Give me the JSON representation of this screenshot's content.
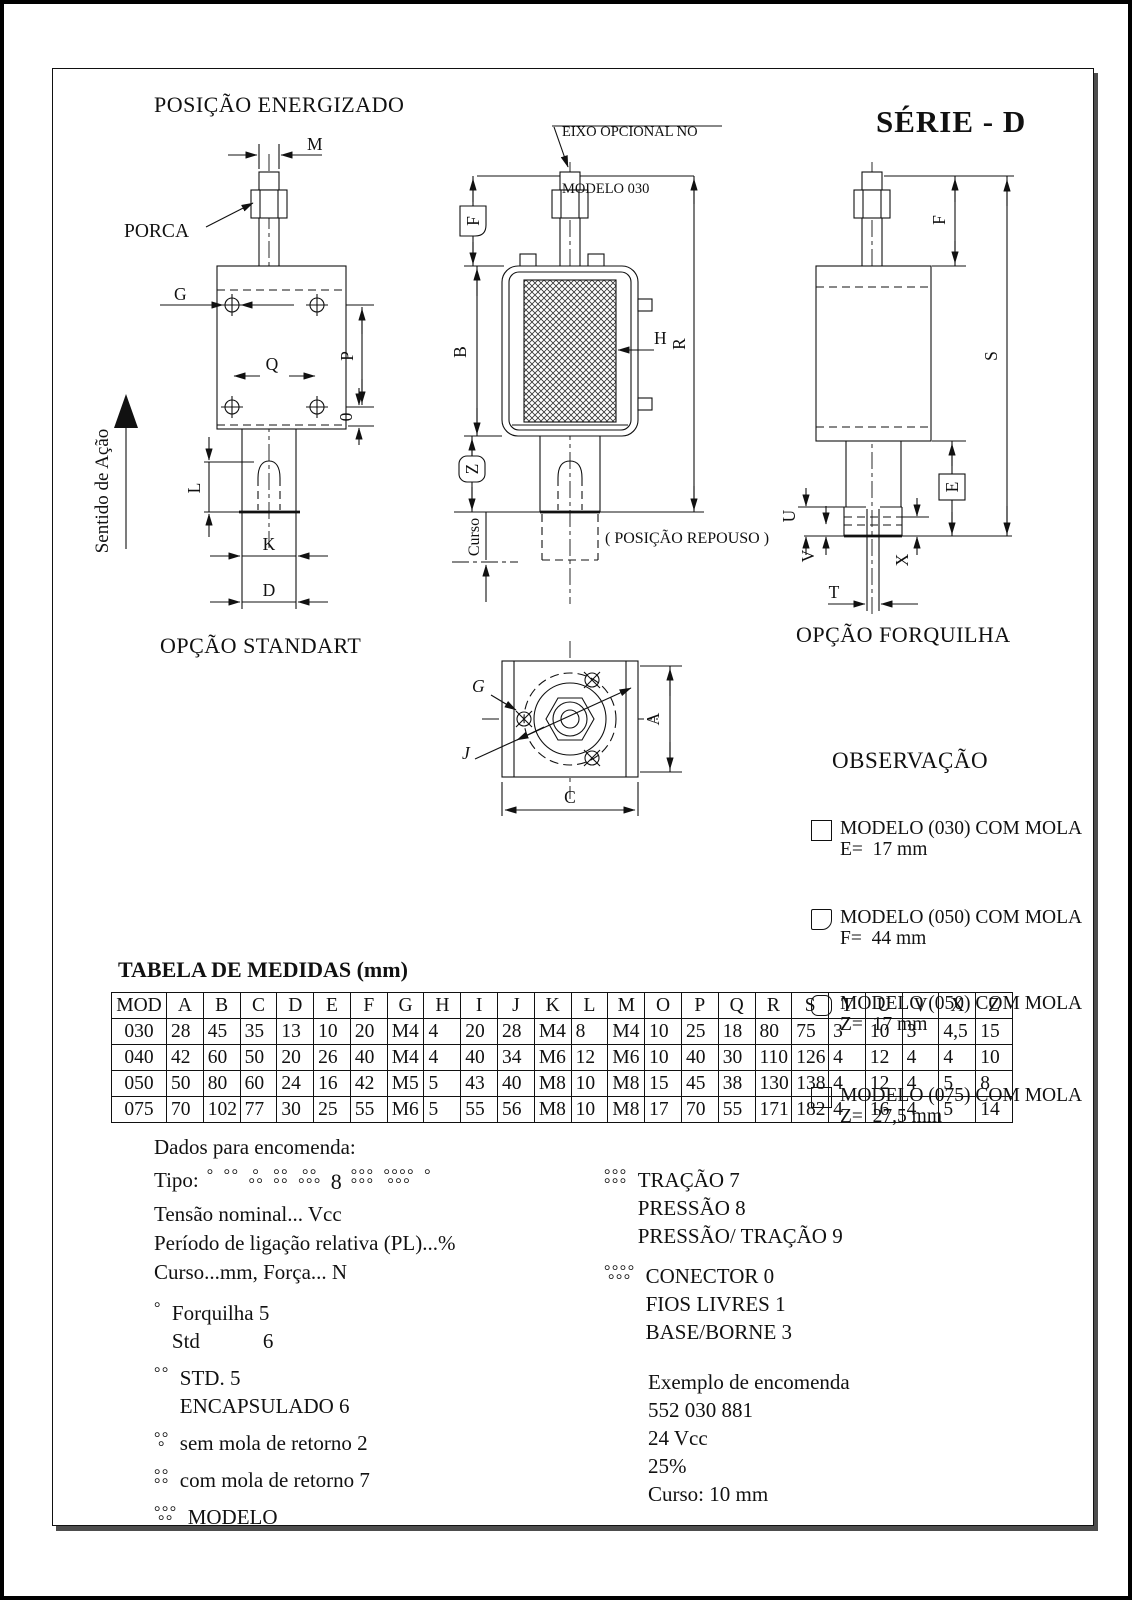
{
  "titles": {
    "posicao_energizado": "POSIÇÃO ENERGIZADO",
    "serie": "SÉRIE - D",
    "eixo_line1": "EIXO OPCIONAL NO",
    "eixo_line2": "MODELO 030",
    "opcao_standart": "OPÇÃO STANDART",
    "opcao_forquilha": "OPÇÃO FORQUILHA",
    "posicao_repouso": "( POSIÇÃO REPOUSO )"
  },
  "labels": {
    "m": "M",
    "porca": "PORCA",
    "g": "G",
    "q": "Q",
    "p": "P",
    "zero": "0",
    "l": "L",
    "k": "K",
    "d": "D",
    "sentido": "Sentido de Ação",
    "f_mid": "F",
    "b": "B",
    "h": "H",
    "r": "R",
    "z": "Z",
    "curso": "Curso",
    "g_bot": "G",
    "j": "J",
    "a": "A",
    "c": "C",
    "f_right": "F",
    "s": "S",
    "e": "E",
    "u": "U",
    "v": "V",
    "t": "T",
    "x": "X"
  },
  "observacao": {
    "title": "OBSERVAÇÃO",
    "items": [
      {
        "icon": "square",
        "line1": "MODELO (030) COM MOLA",
        "line2": "E=  17 mm"
      },
      {
        "icon": "corner",
        "line1": "MODELO (050) COM MOLA",
        "line2": "F=  44 mm"
      },
      {
        "icon": "rounded",
        "line1": "MODELO (050) COM MOLA",
        "line2": "Z=  17 mm"
      },
      {
        "icon": "none",
        "line1": "MODELO (075) COM MOLA",
        "line2": "Z=  27,5 mm"
      }
    ]
  },
  "table": {
    "title": "TABELA DE MEDIDAS (mm)",
    "columns": [
      "MOD",
      "A",
      "B",
      "C",
      "D",
      "E",
      "F",
      "G",
      "H",
      "I",
      "J",
      "K",
      "L",
      "M",
      "O",
      "P",
      "Q",
      "R",
      "S",
      "T",
      "U",
      "V",
      "X",
      "Z"
    ],
    "rows": [
      [
        "030",
        "28",
        "45",
        "35",
        "13",
        "10",
        "20",
        "M4",
        "4",
        "20",
        "28",
        "M4",
        "8",
        "M4",
        "10",
        "25",
        "18",
        "80",
        "75",
        "3",
        "10",
        "3",
        "4,5",
        "15"
      ],
      [
        "040",
        "42",
        "60",
        "50",
        "20",
        "26",
        "40",
        "M4",
        "4",
        "40",
        "34",
        "M6",
        "12",
        "M6",
        "10",
        "40",
        "30",
        "110",
        "126",
        "4",
        "12",
        "4",
        "4",
        "10"
      ],
      [
        "050",
        "50",
        "80",
        "60",
        "24",
        "16",
        "42",
        "M5",
        "5",
        "43",
        "40",
        "M8",
        "10",
        "M8",
        "15",
        "45",
        "38",
        "130",
        "138",
        "4",
        "12",
        "4",
        "5",
        "8"
      ],
      [
        "075",
        "70",
        "102",
        "77",
        "30",
        "25",
        "55",
        "M6",
        "5",
        "55",
        "56",
        "M8",
        "10",
        "M8",
        "17",
        "70",
        "55",
        "171",
        "182",
        "4",
        "16",
        "4",
        "5",
        "14"
      ]
    ]
  },
  "encomenda": {
    "heading": "Dados para encomenda:",
    "tipo_label": "Tipo:",
    "tipo_symbols": [
      {
        "top": "°",
        "bottom": ""
      },
      {
        "top": "°°",
        "bottom": ""
      },
      {
        "top": "°",
        "bottom": "°°"
      },
      {
        "top": "°°",
        "bottom": "°°"
      },
      {
        "top": "°°",
        "bottom": "°°°"
      },
      {
        "text": "8"
      },
      {
        "top": "°°°",
        "bottom": "°°°"
      },
      {
        "top": "°°°°",
        "bottom": "°°°"
      },
      {
        "top": "°",
        "bottom": ""
      }
    ],
    "param_lines": [
      "Tensão nominal... Vcc",
      "Período de ligação relativa (PL)...%",
      "Curso...mm, Força... N"
    ],
    "legend_left": [
      {
        "sym": {
          "top": "°",
          "bottom": ""
        },
        "lines": [
          "Forquilha 5",
          "Std            6"
        ]
      },
      {
        "sym": {
          "top": "°°",
          "bottom": ""
        },
        "lines": [
          "STD. 5",
          "ENCAPSULADO 6"
        ]
      },
      {
        "sym": {
          "top": "°°",
          "bottom": "°"
        },
        "lines": [
          "sem mola de retorno 2"
        ]
      },
      {
        "sym": {
          "top": "°°",
          "bottom": "°°"
        },
        "lines": [
          "com mola de retorno 7"
        ]
      },
      {
        "sym": {
          "top": "°°°",
          "bottom": "°°"
        },
        "lines": [
          "MODELO"
        ]
      }
    ],
    "legend_right": [
      {
        "sym": {
          "top": "°°°",
          "bottom": "°°°"
        },
        "lines": [
          "TRAÇÃO 7",
          "PRESSÃO 8",
          "PRESSÃO/ TRAÇÃO 9"
        ]
      },
      {
        "sym": {
          "top": "°°°°",
          "bottom": "°°°"
        },
        "lines": [
          "CONECTOR 0",
          "FIOS LIVRES 1",
          "BASE/BORNE 3"
        ]
      }
    ],
    "exemplo": {
      "title": "Exemplo de encomenda",
      "lines": [
        "552 030 881",
        "24 Vcc",
        "25%",
        "Curso: 10 mm"
      ]
    }
  }
}
